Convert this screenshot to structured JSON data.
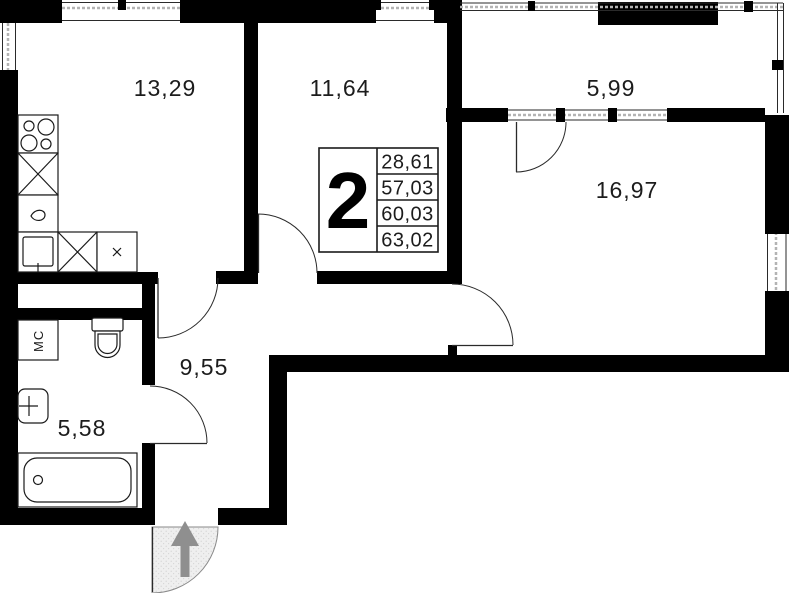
{
  "plan": {
    "unit": {
      "number": "2",
      "areas": [
        "28,61",
        "57,03",
        "60,03",
        "63,02"
      ]
    },
    "rooms": [
      {
        "id": "kitchen-living",
        "area": "13,29"
      },
      {
        "id": "bedroom",
        "area": "11,64"
      },
      {
        "id": "balcony",
        "area": "5,99"
      },
      {
        "id": "living-room",
        "area": "16,97"
      },
      {
        "id": "hallway",
        "area": "9,55"
      },
      {
        "id": "bathroom",
        "area": "5,58"
      }
    ],
    "labels": {
      "washing_machine": "МС"
    },
    "colors": {
      "wall": "#000000",
      "line": "#1a1a1a",
      "window_dash": "#b3b3b3",
      "entry_fill": "#efefef",
      "arrow": "#8f8f8f"
    }
  }
}
